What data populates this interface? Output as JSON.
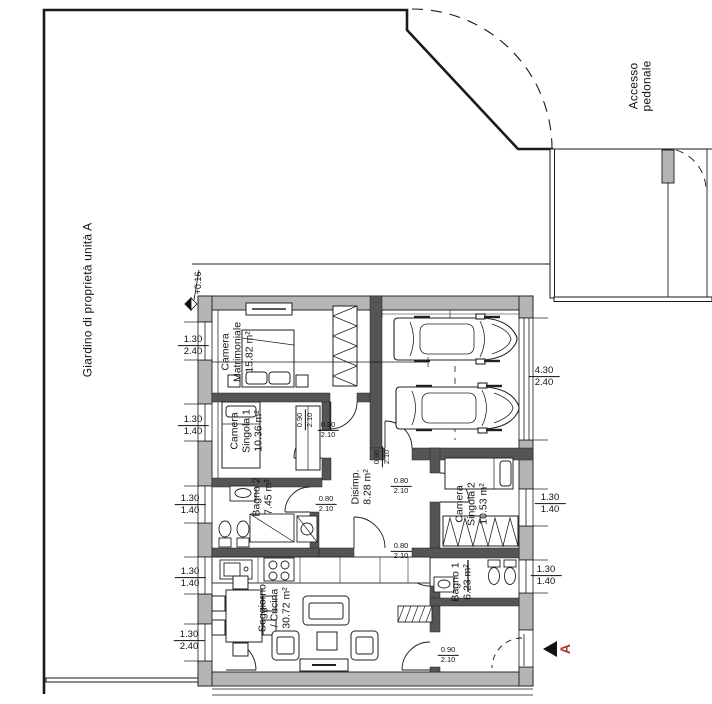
{
  "drawing": {
    "garden_label": "Giardino di proprietà unità A",
    "pedestrian_access_label": "Accesso\npedonale",
    "level_marker": "+0.16",
    "section_marker": "A"
  },
  "rooms": {
    "camera_matrimoniale": "Camera\nMatrimoniale\n15.82 m²",
    "camera_singola_1": "Camera\nSingola 1\n10.36 m²",
    "bagno_2": "Bagno 2\n7.45 m²",
    "disimpegno": "Disimp.\n8.28 m²",
    "camera_singola_2": "Camera\nSingola 2\n10.53 m²",
    "bagno_1": "Bagno 1\n6.23 m²",
    "soggiorno_cucina": "Soggiorno\n/ Cucina\n30.72 m²"
  },
  "dims": {
    "left": [
      {
        "w": "1.30",
        "h": "2.40"
      },
      {
        "w": "1.30",
        "h": "1.40"
      },
      {
        "w": "1.30",
        "h": "1.40"
      },
      {
        "w": "1.30",
        "h": "1.40"
      },
      {
        "w": "1.30",
        "h": "2.40"
      }
    ],
    "right": [
      {
        "w": "4.30",
        "h": "2.40"
      },
      {
        "w": "1.30",
        "h": "1.40"
      },
      {
        "w": "1.30",
        "h": "1.40"
      }
    ],
    "doors": [
      {
        "w": "0.90",
        "h": "2.10"
      },
      {
        "w": "0.80",
        "h": "2.10"
      },
      {
        "w": "0.90",
        "h": "2.10"
      },
      {
        "w": "0.80",
        "h": "2.10"
      },
      {
        "w": "0.80",
        "h": "2.10"
      },
      {
        "w": "0.80",
        "h": "2.10"
      },
      {
        "w": "0.90",
        "h": "2.10"
      }
    ]
  },
  "colors": {
    "exterior_wall": "#b5b5b5",
    "interior_wall": "#555555",
    "line": "#1a1a1a",
    "section_red": "#b03232"
  }
}
